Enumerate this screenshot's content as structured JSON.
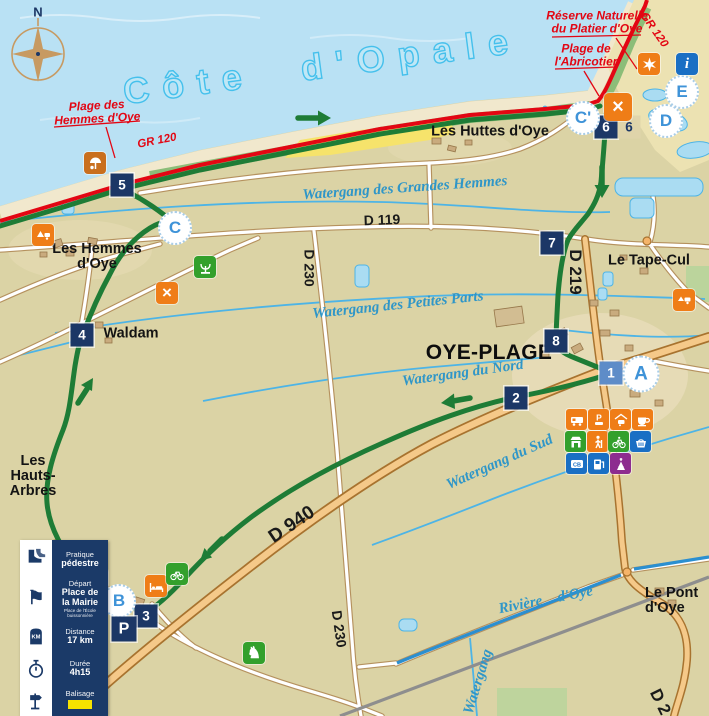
{
  "sea_title": {
    "text": "Côte d'Opale"
  },
  "compass": {
    "north": "N"
  },
  "coast": {
    "plage_hemmes_1": "Plage des",
    "plage_hemmes_2": "Hemmes d'Oye",
    "gr120_west": "GR 120",
    "gr120_east": "GR 120",
    "reserve_1": "Réserve Naturelle",
    "reserve_2": "du Platier d'Oye",
    "abricotier_1": "Plage de",
    "abricotier_2": "l'Abricotier"
  },
  "places": {
    "les_huttes": "Les Huttes d'Oye",
    "les_hemmes_1": "Les Hemmes",
    "les_hemmes_2": "d'Oye",
    "waldam": "Waldam",
    "tape_cul": "Le Tape-Cul",
    "oye_plage": "OYE-PLAGE",
    "hauts_arbres_1": "Les",
    "hauts_arbres_2": "Hauts-",
    "hauts_arbres_3": "Arbres",
    "pont_oye_1": "Le Pont",
    "pont_oye_2": "d'Oye"
  },
  "water": {
    "grandes_hemmes": "Watergang des Grandes Hemmes",
    "petites_parts": "Watergang des Petites Parts",
    "nord": "Watergang du Nord",
    "sud": "Watergang du Sud",
    "riviere": "Rivière  d'Oye",
    "partial": "Watergang"
  },
  "roads": {
    "d119": "D 119",
    "d230_north": "D 230",
    "d219": "D 219",
    "d940": "D 940",
    "d230_south": "D 230",
    "d_partial": "D 2"
  },
  "route": {
    "waypoints": [
      {
        "n": "1"
      },
      {
        "n": "2"
      },
      {
        "n": "3"
      },
      {
        "n": "4"
      },
      {
        "n": "5"
      },
      {
        "n": "6"
      },
      {
        "n": "7"
      },
      {
        "n": "8"
      }
    ],
    "ghost6": "6"
  },
  "letters": {
    "a": "A",
    "b": "B",
    "c": "C",
    "c_prime": "C'",
    "d": "D",
    "e": "E"
  },
  "glyphs": {
    "north": "N",
    "parking": "P",
    "info": "i",
    "atm": "CB",
    "x_marker": "×",
    "restaurant_x": "×",
    "horse": "♞",
    "flag": "⚑",
    "km": "KM"
  },
  "legend": {
    "practice_label": "Pratique",
    "practice_value": "pédestre",
    "depart_label": "Départ",
    "depart_value_1": "Place de",
    "depart_value_2": "la Mairie",
    "depart_note_1": "Place de l'École",
    "depart_note_2": "buissonnière",
    "distance_label": "Distance",
    "distance_value": "17 km",
    "duration_label": "Durée",
    "duration_value": "4h15",
    "waymark_label": "Balisage"
  },
  "icon_legend": [
    "beach-icon",
    "campsite-icon",
    "restaurant-icon",
    "nature-garden-icon",
    "trail-crossing-icon",
    "orientation-table-icon",
    "info-icon",
    "campervan-area-icon",
    "motorhome-icon",
    "motorhome-parking-icon",
    "motorhome-shelter-icon",
    "cafe-icon",
    "market-icon",
    "hiking-icon",
    "cycling-icon",
    "shopping-icon",
    "atm-icon",
    "fuel-icon",
    "church-icon",
    "hotel-icon",
    "accueil-velo-icon",
    "leisure-area-icon",
    "horse-riding-icon",
    "parking-icon"
  ],
  "colors": {
    "sea": "#b9e1f4",
    "land": "#dbd3a5",
    "dune_green": "#8cbd78",
    "sand": "#f6e36b",
    "beach": "#f1e8cd",
    "route_green": "#1e7c36",
    "gr_red": "#e30613",
    "water_blue": "#4db4e6",
    "water_label_blue": "#2f96c8",
    "road_casing": "#b5915e",
    "road_orange": "#f5c989",
    "railway_gray": "#8e8e8e",
    "waypoint_navy": "#1c3766",
    "waypoint_start_blue": "#5e8cc8",
    "letter_blue": "#3f93d8",
    "icon_orange": "#ef7d17",
    "icon_green": "#33a02c",
    "icon_blue": "#1a6fc4",
    "icon_purple": "#8d2c8f",
    "legend_navy": "#1b3a68",
    "balisage_yellow": "#f6e300"
  }
}
